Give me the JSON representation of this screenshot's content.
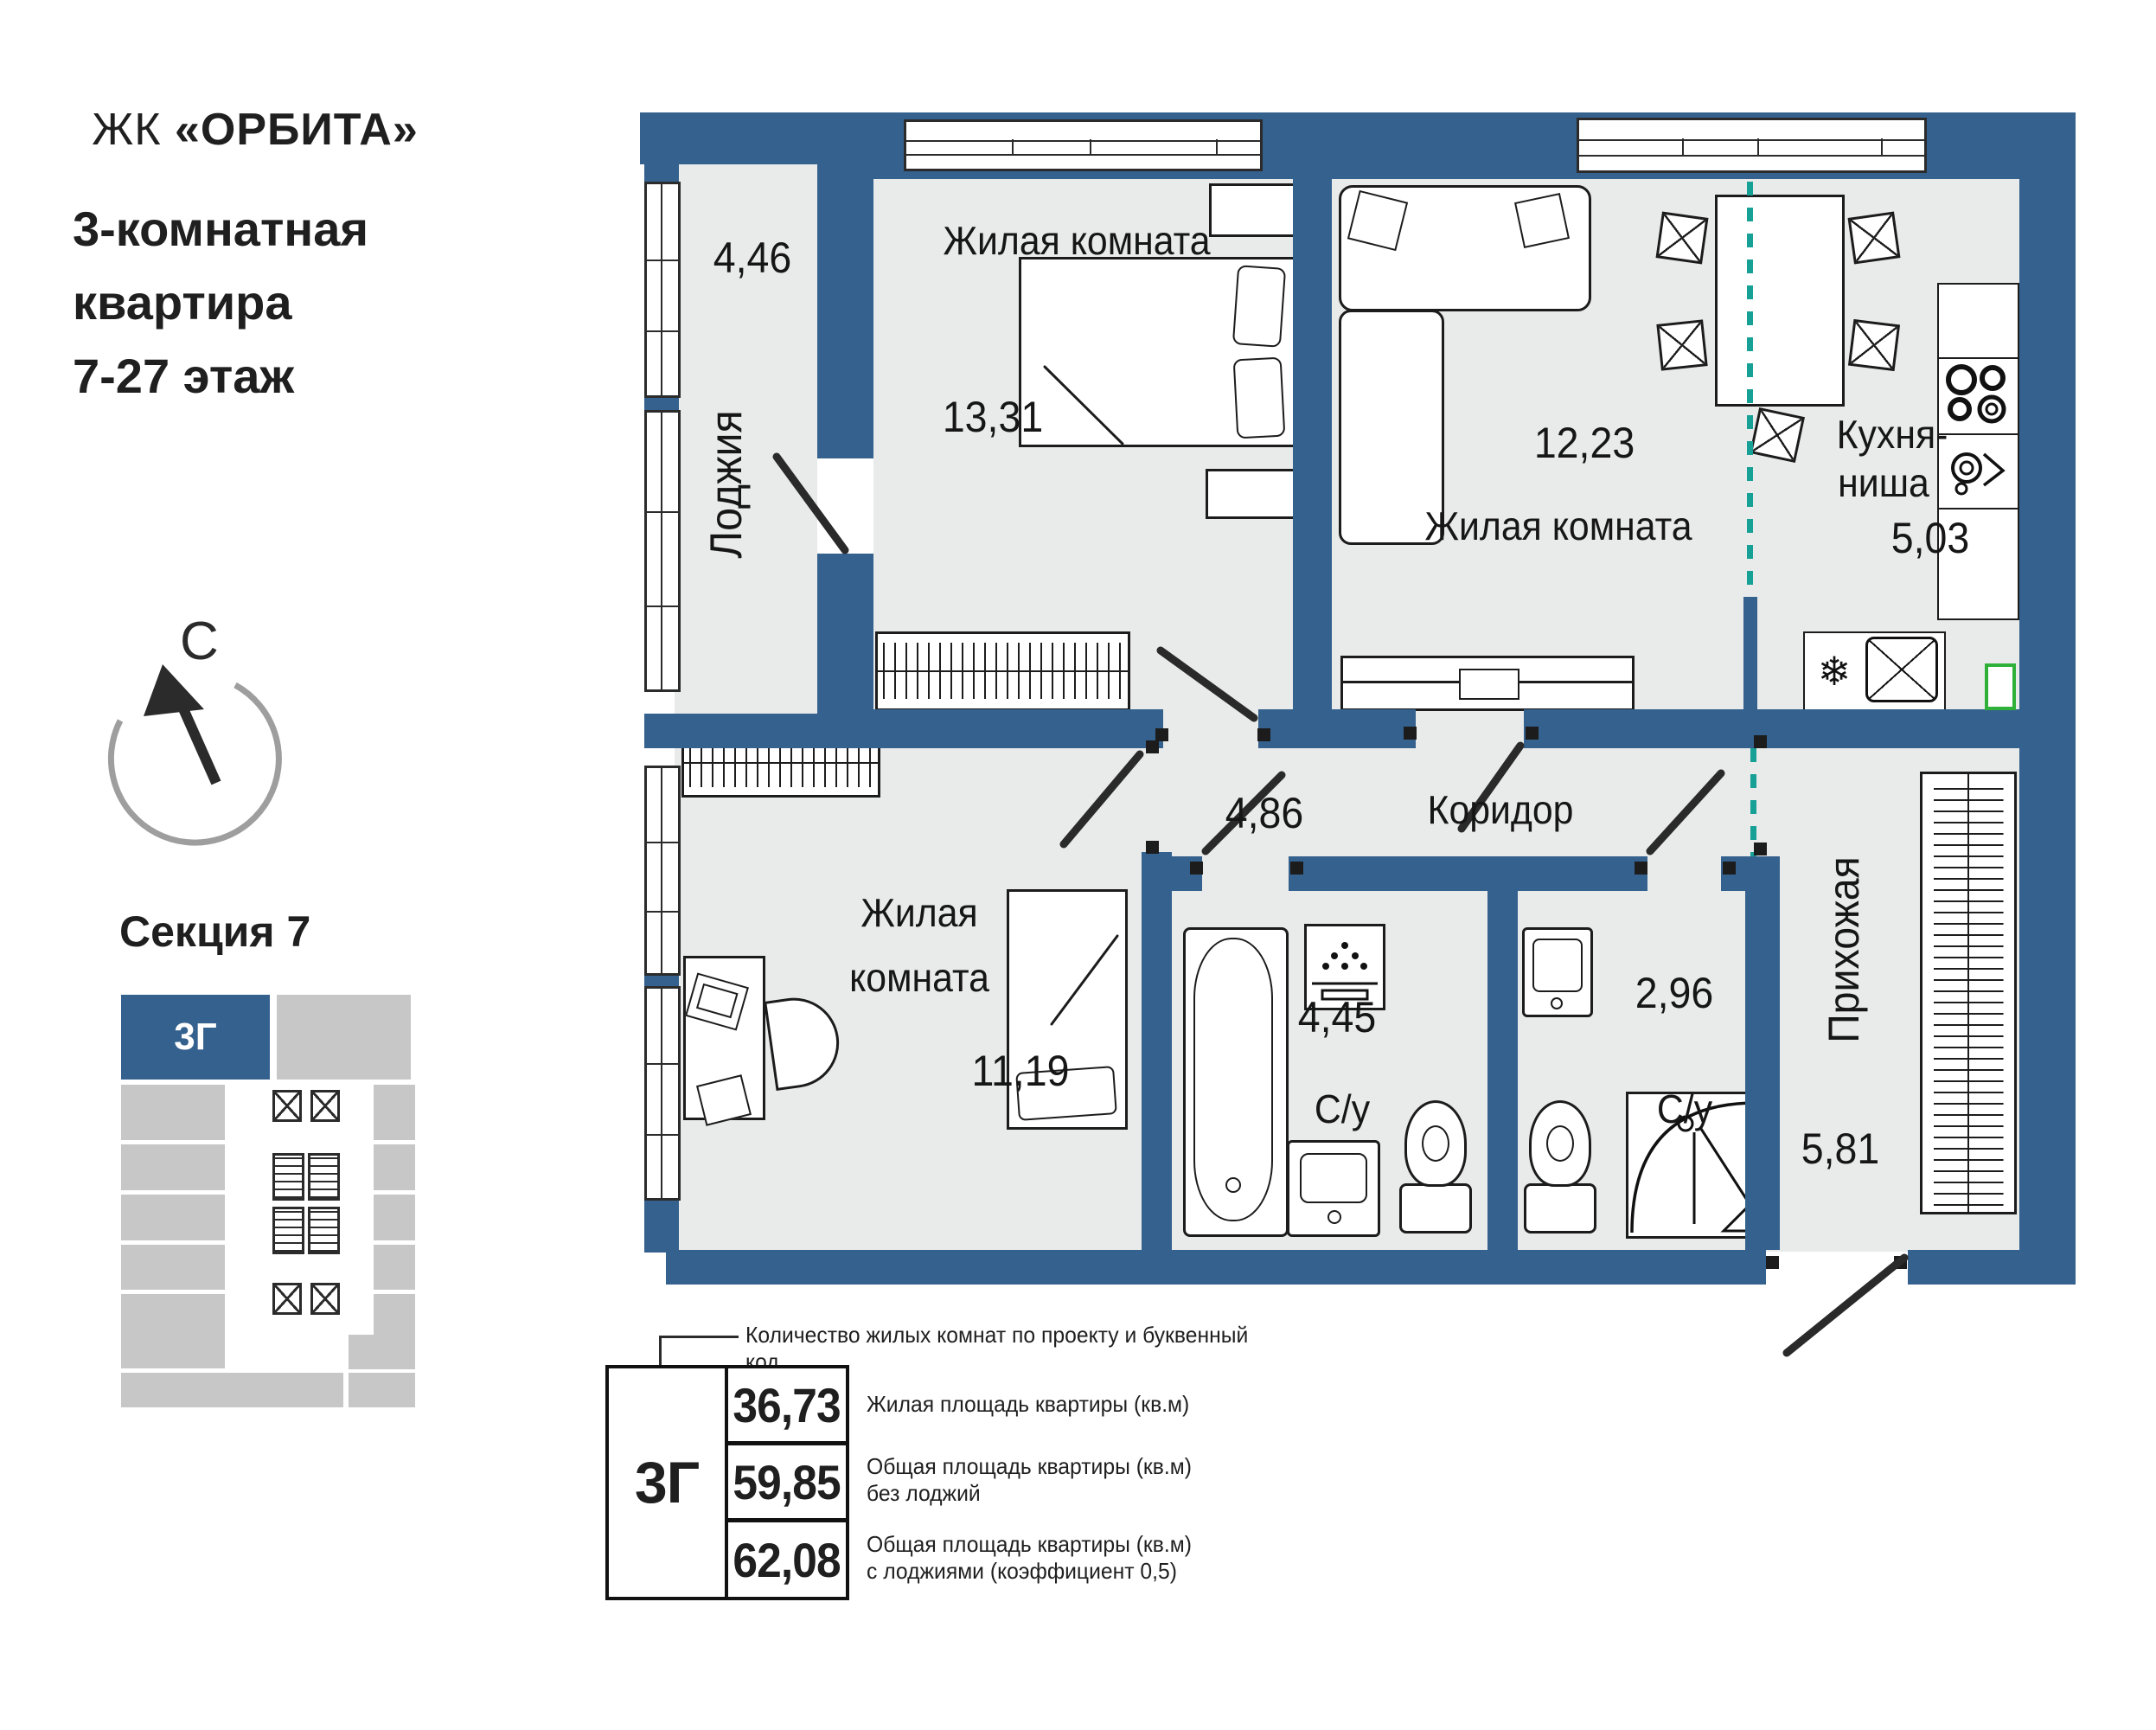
{
  "header": {
    "brand_prefix": "ЖК ",
    "brand_name": "«ОРБИТА»",
    "subtitle_line1": "3-комнатная",
    "subtitle_line2": "квартира",
    "subtitle_line3": "7-27 этаж"
  },
  "compass": {
    "letter": "С"
  },
  "section": {
    "title": "Секция 7",
    "unit_code": "3Г"
  },
  "plan": {
    "rooms": {
      "loggia": {
        "label": "Лоджия",
        "area": "4,46"
      },
      "bedroom1": {
        "label": "Жилая комната",
        "area": "13,31"
      },
      "living": {
        "label": "Жилая комната",
        "area": "12,23"
      },
      "kitchen": {
        "label_line1": "Кухня-",
        "label_line2": "ниша",
        "area": "5,03"
      },
      "corridor": {
        "label": "Коридор",
        "area": "4,86"
      },
      "bedroom2": {
        "label_line1": "Жилая",
        "label_line2": "комната",
        "area": "11,19"
      },
      "bath1": {
        "label": "С/у",
        "area": "4,45"
      },
      "bath2": {
        "label": "С/у",
        "area": "2,96"
      },
      "hallway": {
        "label": "Прихожая",
        "area": "5,81"
      }
    }
  },
  "legend": {
    "note": "Количество жилых комнат по проекту и буквенный код",
    "unit_code": "3Г",
    "rows": [
      {
        "value": "36,73",
        "label_line1": "Жилая площадь квартиры (кв.м)",
        "label_line2": ""
      },
      {
        "value": "59,85",
        "label_line1": "Общая площадь квартиры (кв.м)",
        "label_line2": "без лоджий"
      },
      {
        "value": "62,08",
        "label_line1": "Общая площадь квартиры (кв.м)",
        "label_line2": "с лоджиями (коэффициент 0,5)"
      }
    ]
  },
  "colors": {
    "wall": "#35618E",
    "room_fill": "#E9EAEA",
    "divider_teal": "#17A095",
    "minimap_gray": "#C7C7C7",
    "green_marker": "#2FB039"
  }
}
